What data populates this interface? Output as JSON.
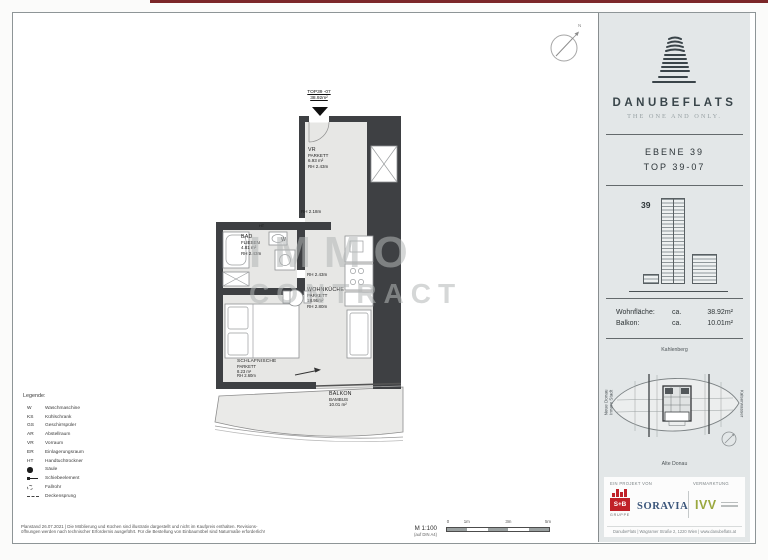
{
  "plan": {
    "top_label_line1": "TOP39 -07",
    "top_label_line2": "38.92m²",
    "compass_n": "N",
    "watermark_line1": "IMMO",
    "watermark_line2": "CONTRACT",
    "rooms": {
      "vr": {
        "name": "VR",
        "material": "PARKETT",
        "area": "6.93 m²",
        "height": "RH 2.43m"
      },
      "bad": {
        "name": "BAD",
        "material": "FLIESEN",
        "area": "4.81 m²",
        "height": "RH 2.43m"
      },
      "wohnkueche": {
        "name": "WOHNKÜCHE",
        "material": "PARKETT",
        "area": "18.95m²",
        "height": "RH 2.80m"
      },
      "schlafnische": {
        "name": "SCHLAFNISCHE",
        "material": "PARKETT",
        "area": "8.23 m²",
        "height": "RH 2.60m"
      },
      "balkon": {
        "name": "BALKON",
        "material": "BAMBUS",
        "area": "10.01 m²"
      }
    },
    "annotations": {
      "rh218": "RH 2.18m",
      "rh243": "RH 2.43m",
      "w": "W",
      "ht": "HT"
    }
  },
  "legend": {
    "title": "Legende:",
    "items": [
      {
        "abbr": "W",
        "label": "Waschmaschine"
      },
      {
        "abbr": "KS",
        "label": "Kühlschrank"
      },
      {
        "abbr": "GS",
        "label": "Geschirrspüler"
      },
      {
        "abbr": "AR",
        "label": "Abstellraum"
      },
      {
        "abbr": "VR",
        "label": "Vorraum"
      },
      {
        "abbr": "ER",
        "label": "Einlagerungsraum"
      },
      {
        "abbr": "HT",
        "label": "Handtuchtrockner"
      },
      {
        "icon": "filled-circle",
        "label": "Säule"
      },
      {
        "icon": "sliding-element",
        "label": "Schiebeelement"
      },
      {
        "icon": "dashed-circle",
        "label": "Fallrohr"
      },
      {
        "icon": "dashed-line",
        "label": "Deckensprung"
      }
    ]
  },
  "footnote": {
    "line1": "Planstand 26.07.2021 | Die Möblierung und Küchen sind illustrativ dargestellt und nicht im Kaufpreis enthalten. Revisions-",
    "line2": "öffnungen werden nach technischer Erfordernis ausgeführt. Für die Bestellung von Einbaumöbel sind Naturmaße erforderlich!"
  },
  "scale": {
    "label": "M 1:100",
    "paper": "(auf DIN A4)",
    "ticks": [
      "0",
      "1m",
      "3m",
      "5m"
    ]
  },
  "sidebar": {
    "brand": {
      "name": "DANUBEFLATS",
      "tagline": "THE ONE AND ONLY."
    },
    "unit": {
      "ebene": "EBENE  39",
      "top": "TOP  39-07",
      "floor_marker": "39"
    },
    "areas": {
      "rows": [
        {
          "label": "Wohnfläche:",
          "approx": "ca.",
          "value": "38.92m²"
        },
        {
          "label": "Balkon:",
          "approx": "ca.",
          "value": "10.01m²"
        }
      ]
    },
    "siteplan": {
      "north": "Kahlenberg",
      "south": "Alte Donau",
      "west_line1": "Neue Donau",
      "west_line2": "Innere Stadt",
      "east": "Kaiserwasser"
    },
    "partners": {
      "project_heading": "EIN PROJEKT VON",
      "marketing_heading": "VERMARKTUNG",
      "sb_name": "S+B",
      "sb_sub": "GRUPPE",
      "soravia": "SORAVIA",
      "ivv": "IVV",
      "contact": "DanubeFlats   |   Wagramer Straße 2, 1220 Wien   |   www.danubeflats.at"
    }
  }
}
